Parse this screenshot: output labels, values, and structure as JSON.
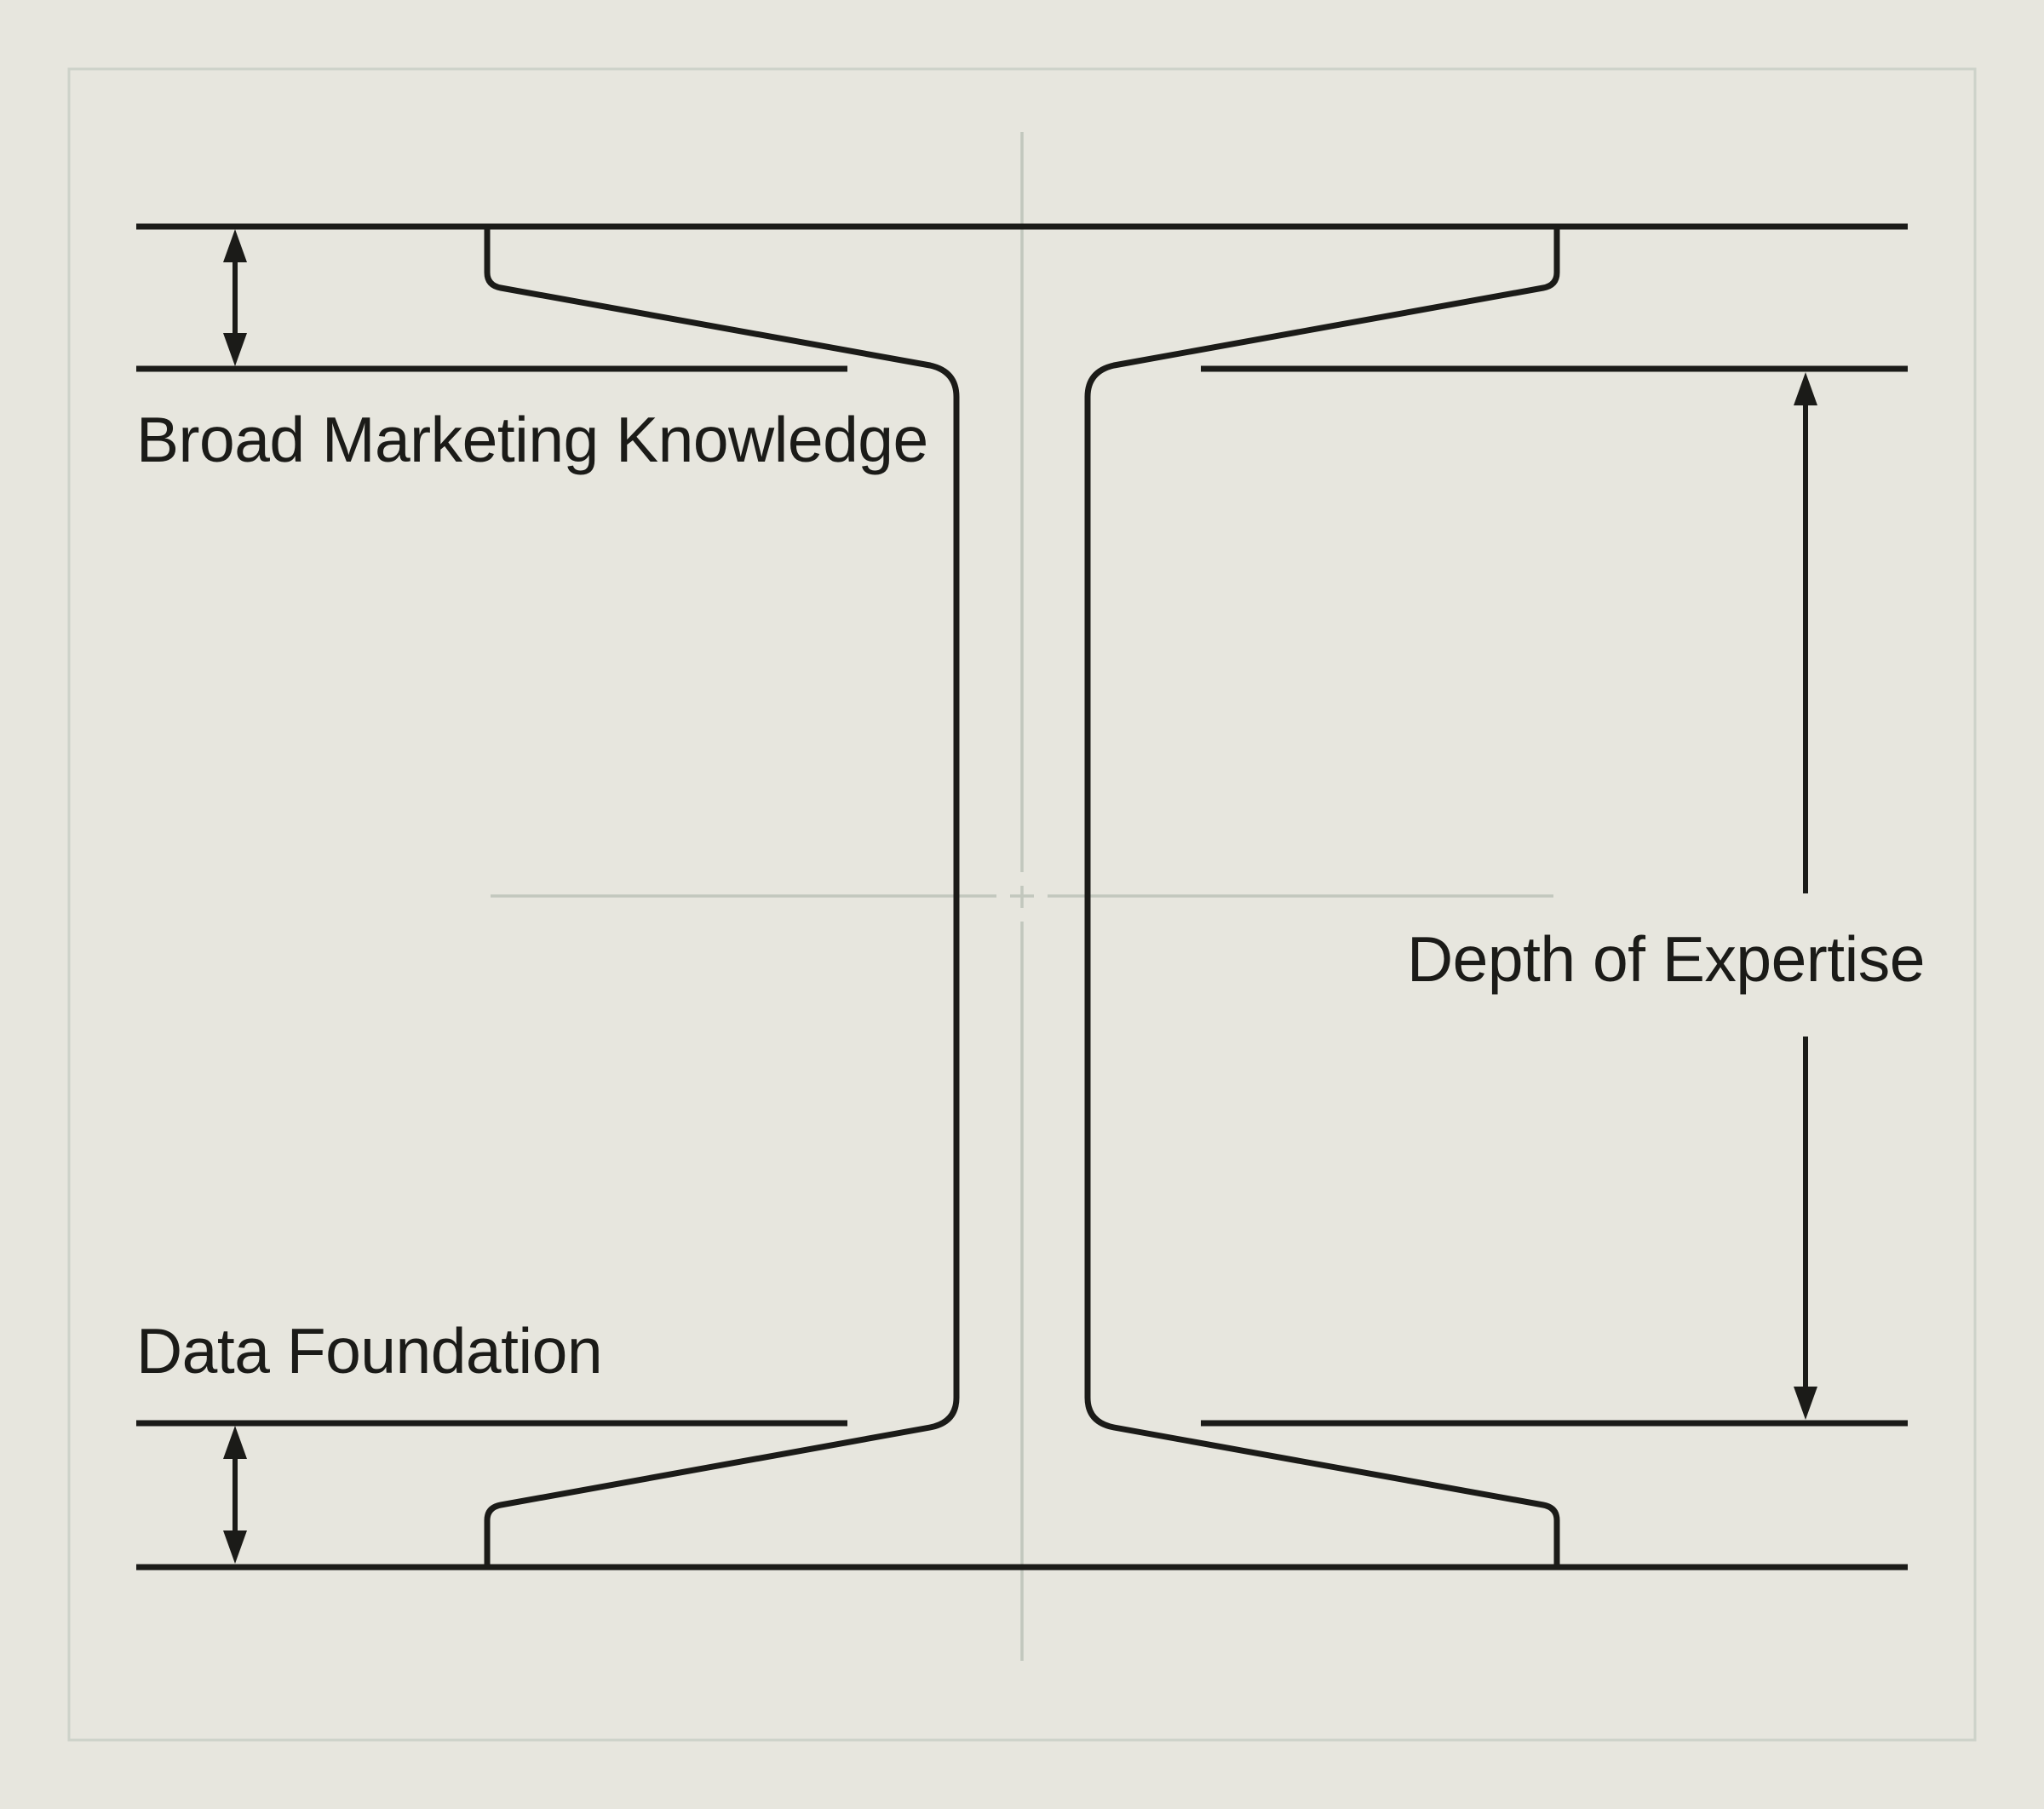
{
  "colors": {
    "background": "#e7e6de",
    "ink": "#1b1b18",
    "centerline": "#c2c7bd",
    "frame": "#cdd2c9"
  },
  "labels": {
    "top_flange": "Broad Marketing Knowledge",
    "web_depth": "Depth of Expertise",
    "bottom_flange": "Data Foundation"
  },
  "icons": {
    "left_top_dimension": "double-headed-vertical-arrow",
    "left_bottom_dimension": "double-headed-vertical-arrow",
    "right_dimension": "double-headed-vertical-arrow-broken-for-label",
    "center_mark": "cad-crosshair-centerlines"
  }
}
